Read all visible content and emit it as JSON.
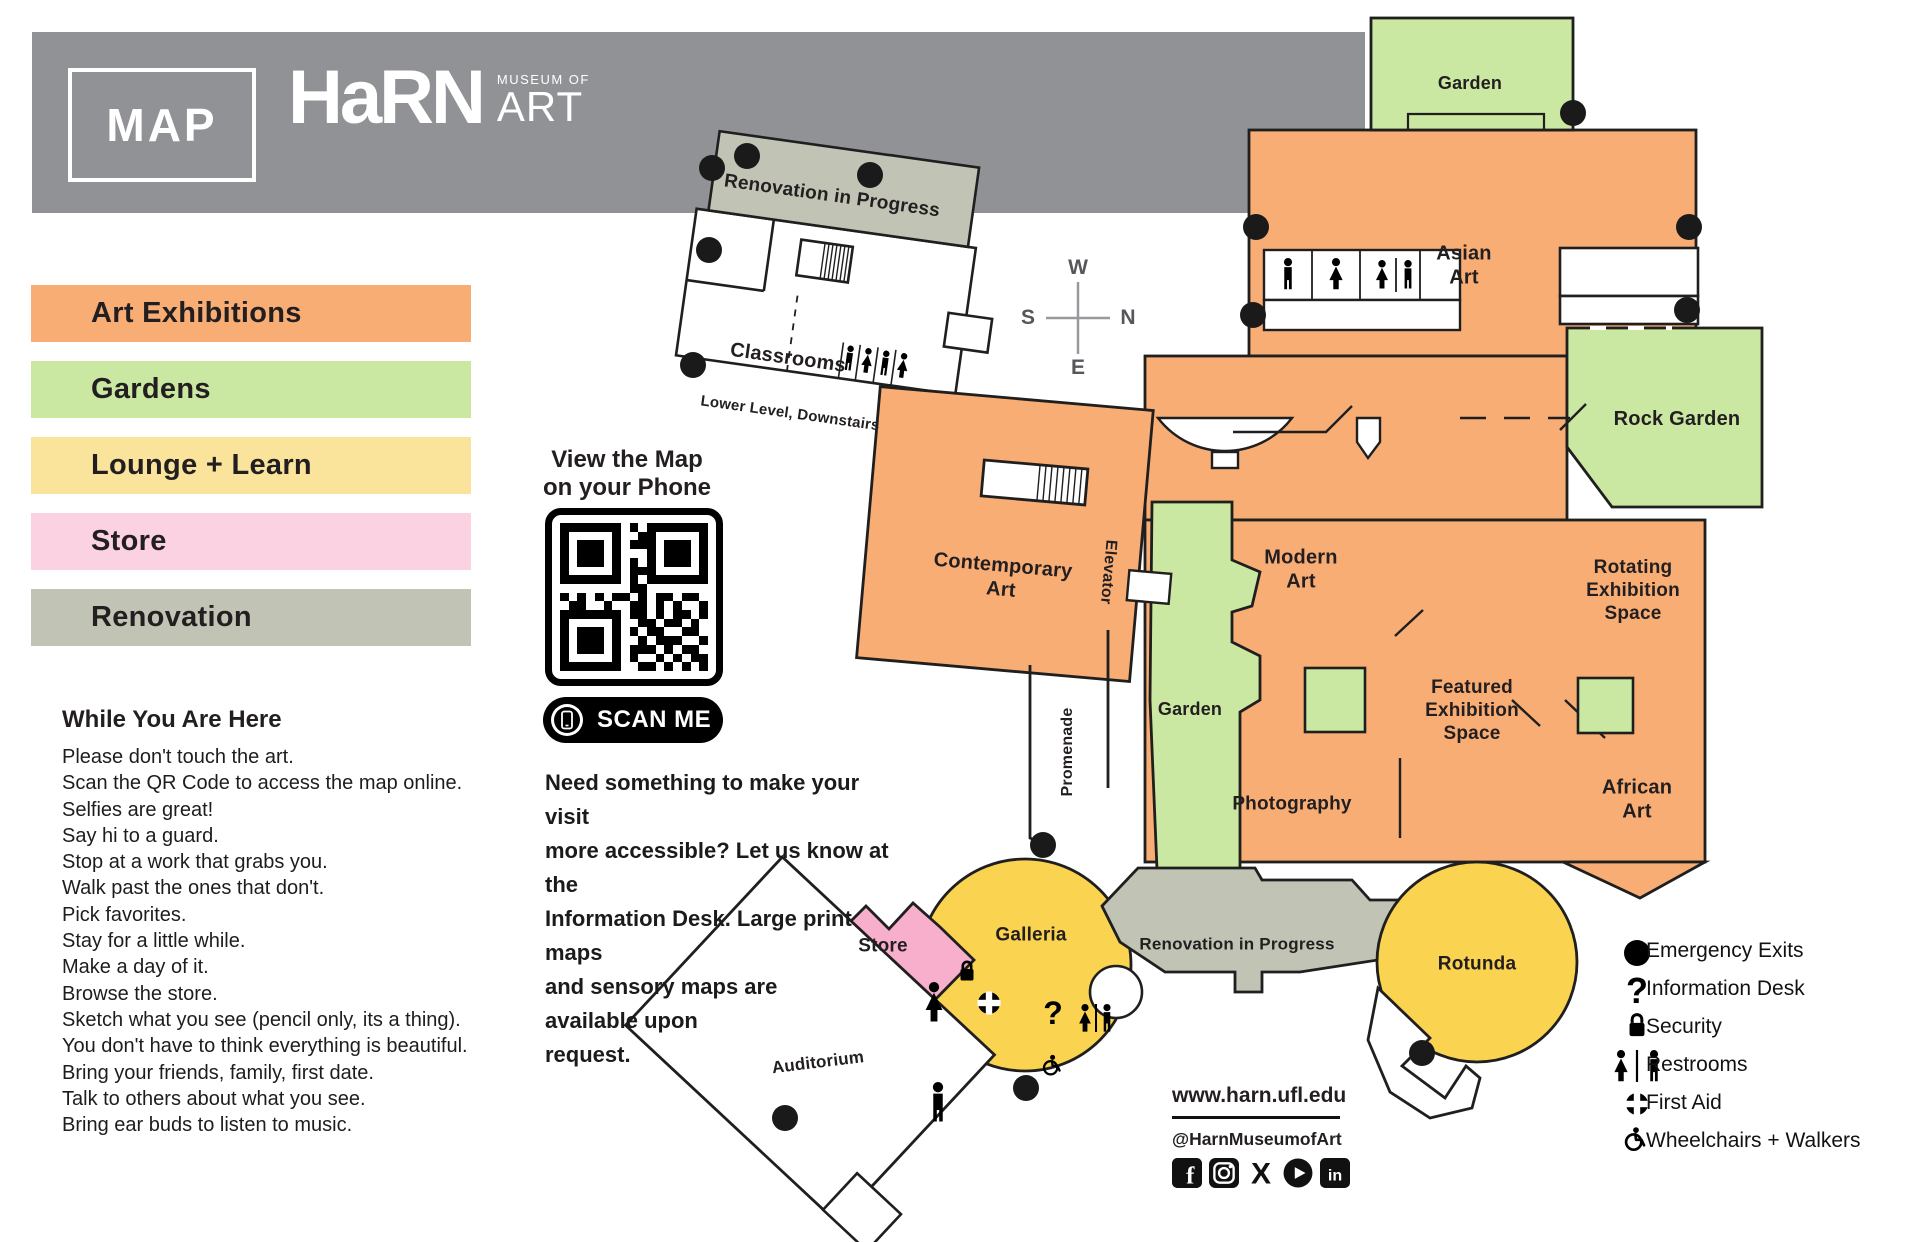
{
  "theme": {
    "banner_gray": "#909296",
    "art_orange": "#F8AD75",
    "garden_green": "#CBE8A3",
    "lounge_yellow": "#FAD350",
    "legend_yellow": "#FAE49C",
    "store_pink": "#F8AFCB",
    "legend_pink": "#FAD2E1",
    "renovation_gray": "#C1C3B4",
    "outline": "#1F1F1F"
  },
  "header": {
    "badge": "MAP",
    "brand": "HaRN",
    "brand_top": "MUSEUM OF",
    "brand_bottom": "ART"
  },
  "legend": {
    "items": [
      {
        "label": "Art Exhibitions",
        "color": "#F8AD75"
      },
      {
        "label": "Gardens",
        "color": "#CBE8A3"
      },
      {
        "label": "Lounge + Learn",
        "color": "#FAE49C"
      },
      {
        "label": "Store",
        "color": "#FAD2E1"
      },
      {
        "label": "Renovation",
        "color": "#C1C3B4"
      }
    ]
  },
  "while_here": {
    "title": "While You Are Here",
    "lines": [
      "Please don't touch the art.",
      "Scan the QR Code to access the map online.",
      "Selfies are great!",
      "Say hi to a guard.",
      "Stop at a work that grabs you.",
      "Walk past the ones that don't.",
      "Pick favorites.",
      "Stay for a little while.",
      "Make a day of it.",
      "Browse the store.",
      "Sketch what you see (pencil only, its a thing).",
      "You don't have to think everything is beautiful.",
      "Bring your friends, family, first date.",
      "Talk to others about what you see.",
      "Bring ear buds to listen to music."
    ]
  },
  "qr": {
    "heading_line1": "View the Map",
    "heading_line2": "on your Phone",
    "scan_label": "SCAN ME",
    "matrix": [
      "11111110101111111",
      "10000010011000001",
      "10111010111011101",
      "10111010001011101",
      "10111010101011101",
      "10000010111000001",
      "11111110101111111",
      "00000000110000000",
      "10101011010110110",
      "01100100110101001",
      "11111110110101101",
      "10000010011011010",
      "10111010101100110",
      "10111010010111001",
      "10111010111010110",
      "10000010100101011",
      "11111110011010101"
    ]
  },
  "accessibility": {
    "lines": [
      "Need something to make your visit",
      "more accessible? Let us know at the",
      "Information Desk. Large print maps",
      "and sensory maps are",
      "available upon",
      "request."
    ]
  },
  "compass": {
    "n": "N",
    "s": "S",
    "e": "E",
    "w": "W"
  },
  "rooms": {
    "renovation_upper": "Renovation in Progress",
    "classrooms": "Classrooms",
    "lower_level_note": "Lower Level, Downstairs",
    "garden_north": "Garden",
    "asian_art": "Asian Art",
    "rock_garden": "Rock Garden",
    "contemporary_art": "Contemporary Art",
    "elevator": "Elevator",
    "modern_art": "Modern Art",
    "rotating_exhibition": "Rotating Exhibition Space",
    "featured_exhibition": "Featured Exhibition Space",
    "garden_central": "Garden",
    "promenade": "Promenade",
    "photography": "Photography",
    "african_art": "African Art",
    "galleria": "Galleria",
    "store": "Store",
    "auditorium": "Auditorium",
    "rotunda": "Rotunda",
    "renovation_lower": "Renovation in Progress"
  },
  "icons": {
    "question_mark": "?",
    "facebook_glyph": "f",
    "x_glyph": "X",
    "linkedin_glyph": "in"
  },
  "map_legend": {
    "items": [
      {
        "icon": "emergency-exit-dot",
        "label": "Emergency Exits"
      },
      {
        "icon": "question-mark",
        "label": "Information Desk"
      },
      {
        "icon": "lock",
        "label": "Security"
      },
      {
        "icon": "restrooms",
        "label": "Restrooms"
      },
      {
        "icon": "first-aid-cross",
        "label": "First Aid"
      },
      {
        "icon": "wheelchair",
        "label": "Wheelchairs + Walkers"
      }
    ]
  },
  "footer": {
    "website": "www.harn.ufl.edu",
    "handle": "@HarnMuseumofArt"
  }
}
